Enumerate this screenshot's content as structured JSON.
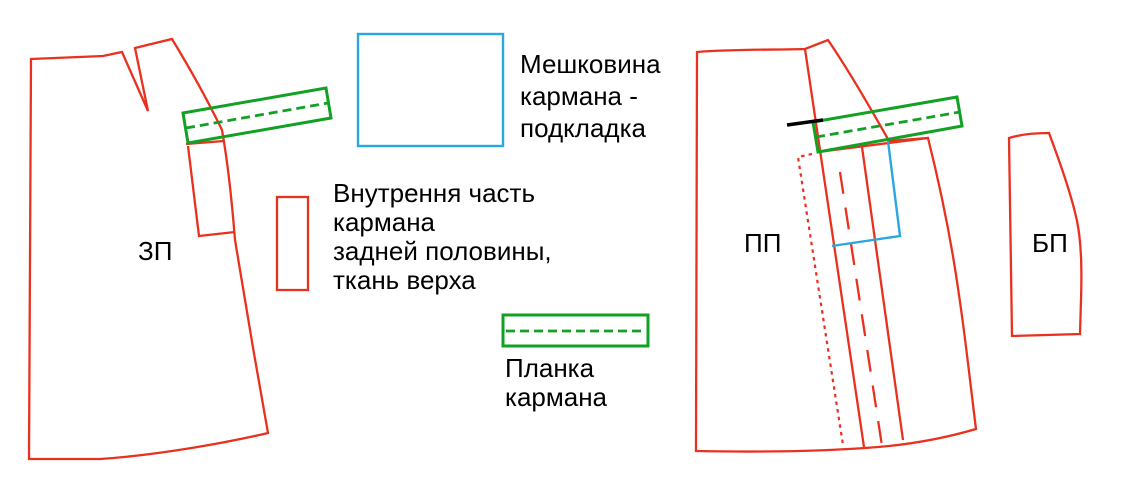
{
  "title": "Схема деталей кроя с карманом",
  "colors": {
    "red": "#e8311f",
    "green": "#12a124",
    "blue": "#2ba7df",
    "mark": "#000000",
    "text": "#000000",
    "background": "#ffffff"
  },
  "pieces": {
    "back_half": {
      "label": "ЗП"
    },
    "front_half": {
      "label": "ПП"
    },
    "side_piece": {
      "label": "БП"
    }
  },
  "legend": {
    "pocket_bag": "Мешковина\nкармана -\nподкладка",
    "inner_pocket": "Внутрення часть\nкармана\nзадней половины,\nткань верха",
    "placket": "Планка\nкармана"
  }
}
